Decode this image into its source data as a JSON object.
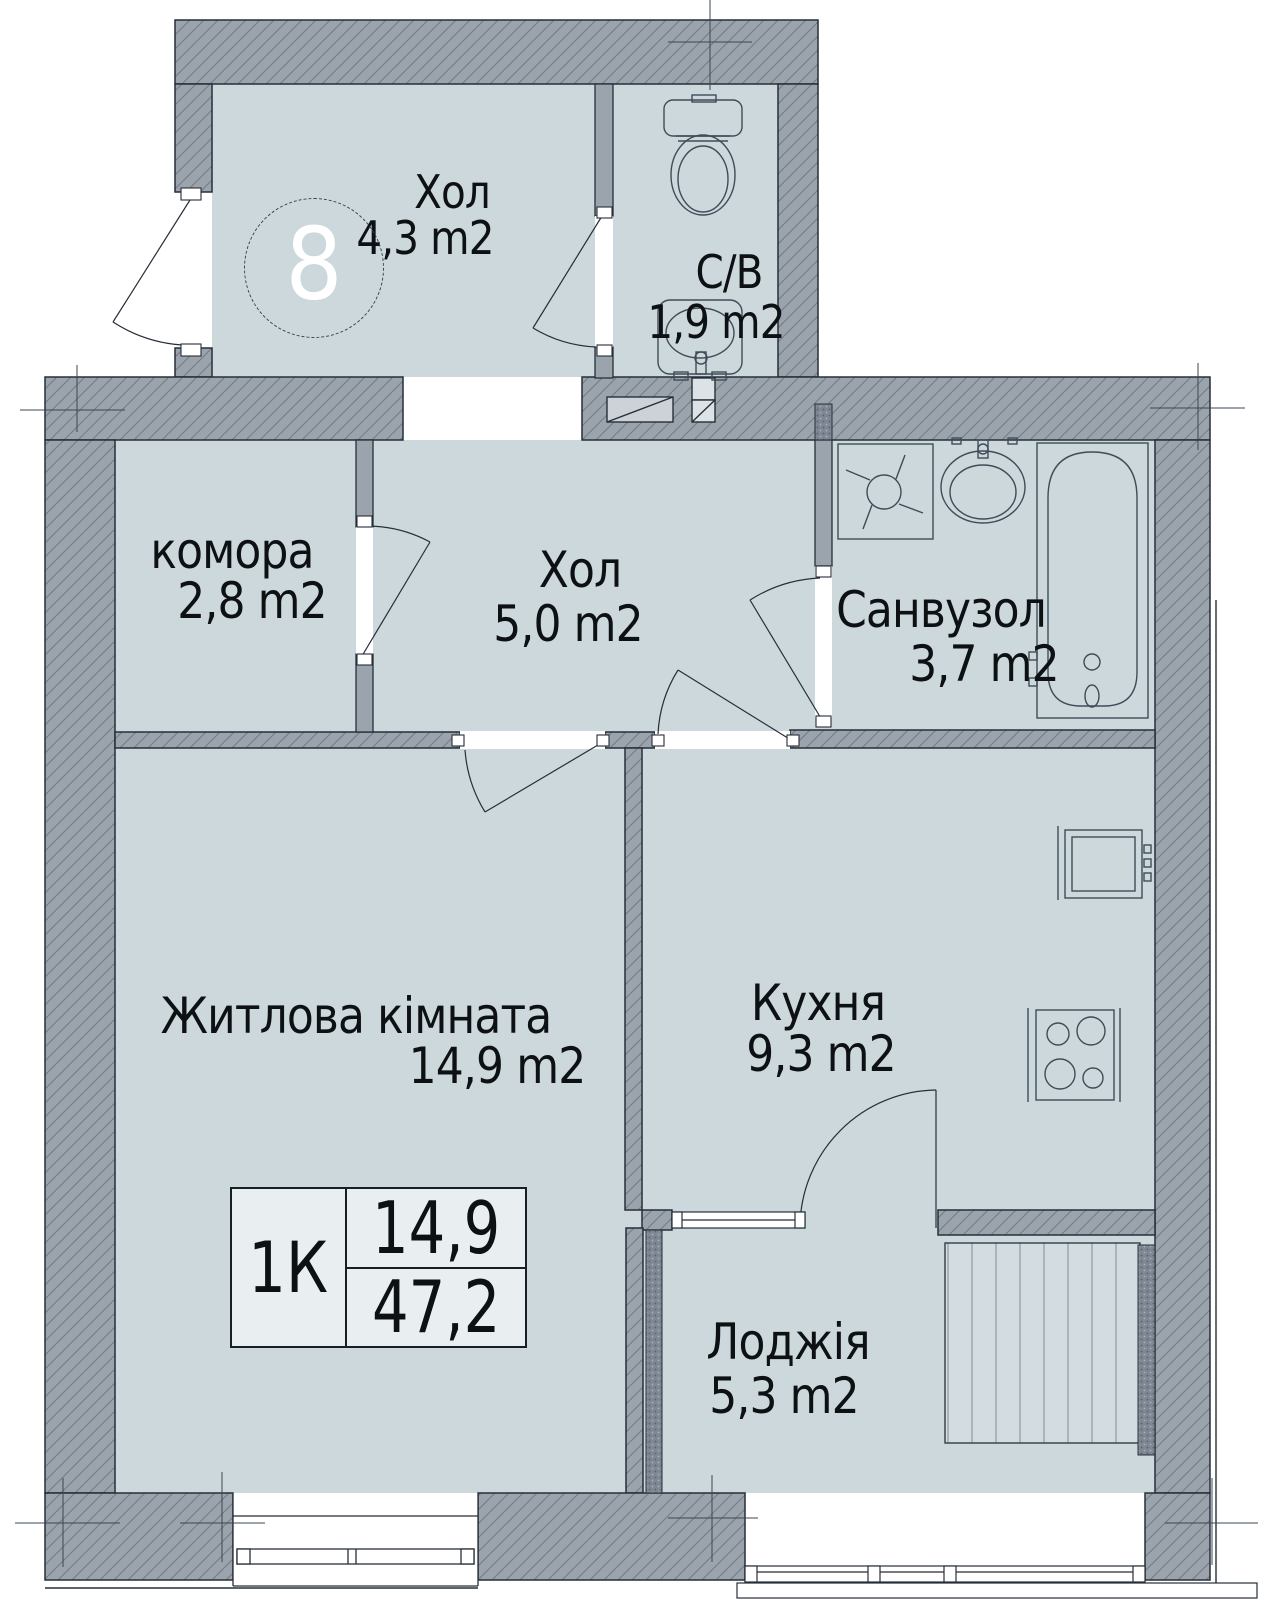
{
  "unit": {
    "number": "8",
    "type": "1К"
  },
  "rooms": {
    "vestibule": {
      "name": "Хол",
      "area": "4,3 m2"
    },
    "wc": {
      "name": "С/В",
      "area": "1,9 m2"
    },
    "storage": {
      "name": "комора",
      "area": "2,8 m2"
    },
    "hall": {
      "name": "Хол",
      "area": "5,0 m2"
    },
    "bathroom": {
      "name": "Санвузол",
      "area": "3,7 m2"
    },
    "living": {
      "name": "Житлова кімната",
      "area": "14,9 m2"
    },
    "kitchen": {
      "name": "Кухня",
      "area": "9,3 m2"
    },
    "loggia": {
      "name": "Лоджія",
      "area": "5,3 m2"
    }
  },
  "stamp": {
    "type_label": "1К",
    "living_area": "14,9",
    "total_area": "47,2"
  },
  "colors": {
    "floor": "#ccd8dc",
    "wall": "#9ba3ac",
    "wall_hatch_line": "#515d6b",
    "partition": "#9ba3ac",
    "insulation": "#7e8793",
    "outline": "#262f38",
    "fixture_line": "#3f4c57",
    "stamp_fill": "#e9eff1",
    "stripe_fill": "#d3dce1",
    "text": "#0e1114",
    "unit_number_text": "#ffffff"
  }
}
